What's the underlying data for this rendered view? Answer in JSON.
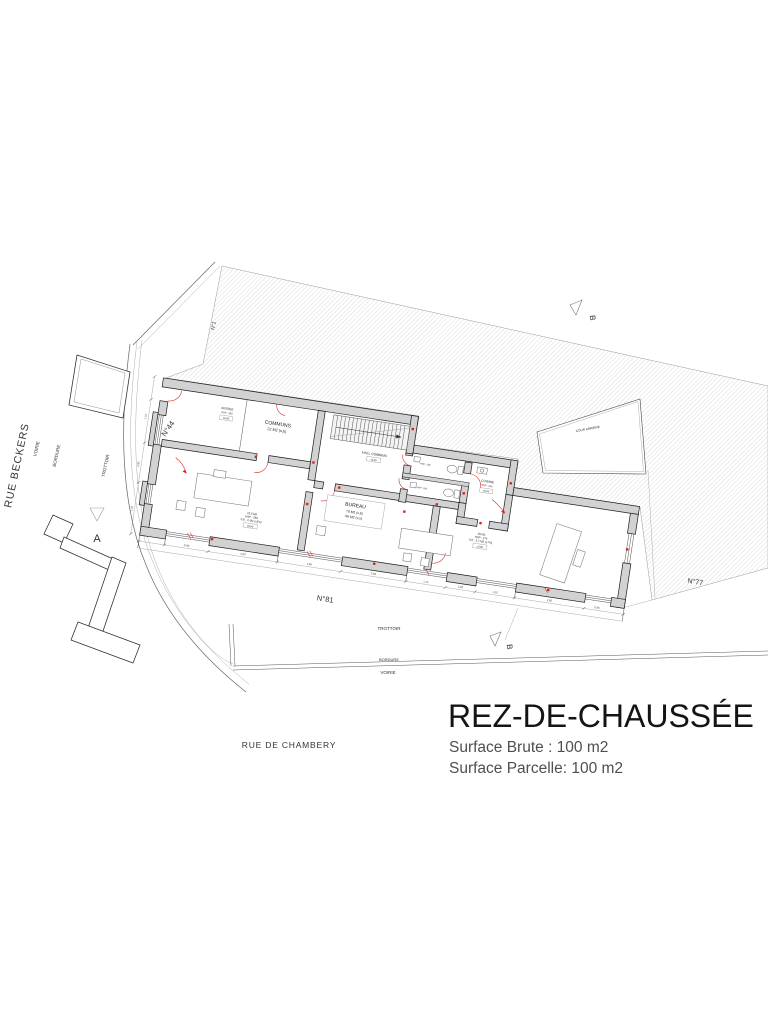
{
  "colors": {
    "wall_fill": "#d2d2d2",
    "red_accent": "#d42420",
    "hatch_line": "#b3b3b3"
  },
  "title_block": {
    "title": "REZ-DE-CHAUSSÉE",
    "surface_brute": "Surface Brute : 100 m2",
    "surface_parcelle": "Surface Parcelle:  100 m2"
  },
  "streets": {
    "rue_beckers": "RUE BECKERS",
    "rue_de_chambery": "RUE DE CHAMBERY",
    "left": {
      "voirie": "VOIRIE",
      "bordure": "BORDURE",
      "trottoir": "TROTTOIR"
    },
    "bottom": {
      "trottoir": "TROTTOIR",
      "bordure": "BORDURE",
      "voirie": "VOIRIE"
    }
  },
  "parcels": {
    "n1": "N°1",
    "n44": "N°44",
    "n77": "N°77",
    "n81": "N°81"
  },
  "section_markers": {
    "a": "A",
    "b_top": "B",
    "b_bottom": "B"
  },
  "rooms": {
    "entree": {
      "name": "ENTREE",
      "hsp": "HSP : 260",
      "niv": "±0,00"
    },
    "communs": {
      "name": "COMMUNS",
      "area": "22 M2 (s,b)"
    },
    "hall": {
      "name": "HALL COMMUN",
      "niv": "±0,00"
    },
    "wc1": {
      "hsp": "HSP : 245"
    },
    "wc2": {
      "hsp": "HSP : 245"
    },
    "cuisine": {
      "name": "CUISINE",
      "hsp": "HSP : 245",
      "niv": "±0,00"
    },
    "bureau": {
      "name": "BUREAU",
      "area_sb": "70 M2 (s,b)",
      "area_su": "66 M2 (s,u)"
    },
    "left_room": {
      "area": "15,5 M2",
      "hsp": "HSP : 260",
      "se": "S.E : 2 M2 (13%)",
      "niv": "±0,00"
    },
    "right_room": {
      "area": "28 M2",
      "hsp": "HSP : 274",
      "se": "S.E : 2,7 M2 (17%)",
      "niv": "±0,00"
    },
    "cour": {
      "name": "COUR ARRIERE"
    }
  },
  "dimensions": {
    "bottom": [
      "0,98",
      "2,60",
      "1,98",
      "2,60",
      "1,15",
      "2,60",
      "1,10",
      "2,60",
      "0,90"
    ],
    "left": [
      "1,10",
      "2,95",
      "1,25"
    ]
  }
}
